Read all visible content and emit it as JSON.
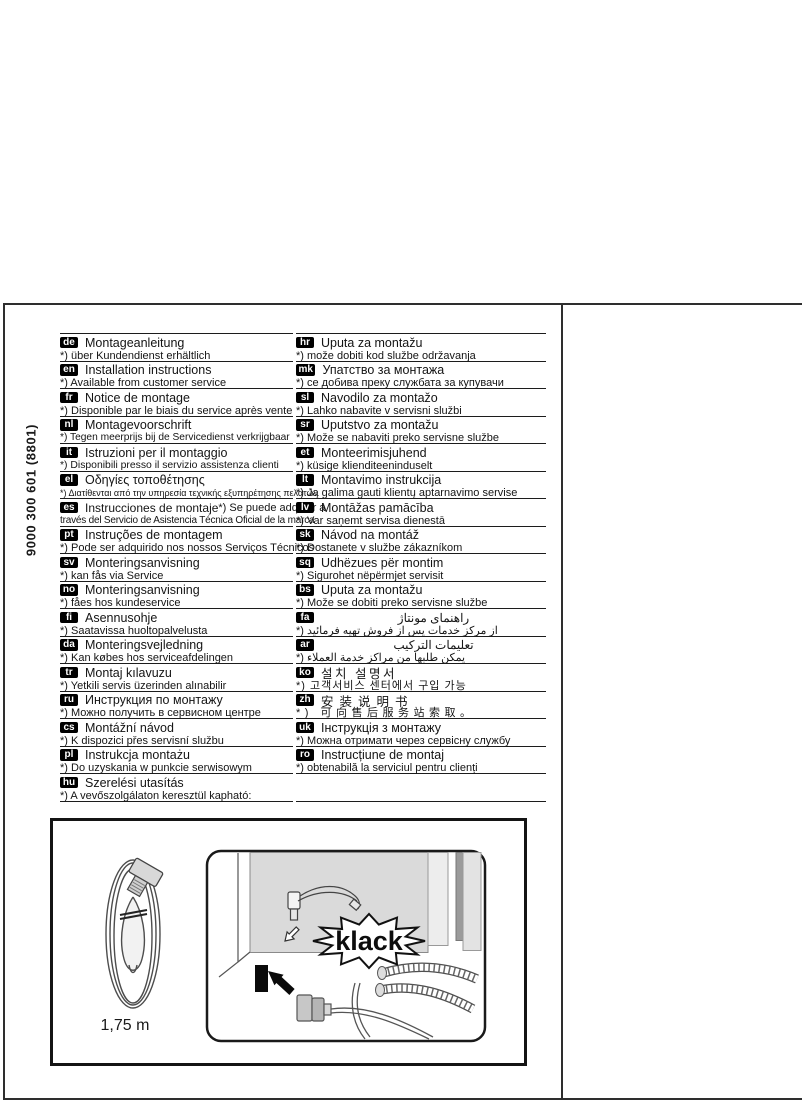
{
  "page": {
    "device_code": "9000 300 601  (8801)",
    "cable_length": "1,75 m",
    "sound_label": "klack"
  },
  "left_column": [
    {
      "code": "de",
      "title": "Montageanleitung",
      "note": "*) über Kundendienst erhältlich"
    },
    {
      "code": "en",
      "title": "Installation instructions",
      "note": "*) Available from customer service"
    },
    {
      "code": "fr",
      "title": "Notice de montage",
      "note": "*) Disponible par le biais du service après vente"
    },
    {
      "code": "nl",
      "title": "Montagevoorschrift",
      "note": "*) Tegen meerprijs bij de Servicedienst verkrijgbaar"
    },
    {
      "code": "it",
      "title": "Istruzioni per il montaggio",
      "note": "*) Disponibili presso il servizio assistenza clienti"
    },
    {
      "code": "el",
      "title": "Οδηγίες τοποθέτησης",
      "note": "*) Διατίθενται από την υπηρεσία τεχνικής εξυπηρέτησης πελατών"
    },
    {
      "code": "es",
      "title": "Instrucciones de montaje",
      "title_note": "*) Se puede adquirir a",
      "note": "través del Servicio de Asistencia Técnica Oficial de la marca"
    },
    {
      "code": "pt",
      "title": "Instruções de montagem",
      "note": "*) Pode ser adquirido nos nossos Serviços Técnicos"
    },
    {
      "code": "sv",
      "title": "Monteringsanvisning",
      "note": "*) kan fås via Service"
    },
    {
      "code": "no",
      "title": "Monteringsanvisning",
      "note": "*) fåes hos kundeservice"
    },
    {
      "code": "fi",
      "title": "Asennusohje",
      "note": "*) Saatavissa huoltopalvelusta"
    },
    {
      "code": "da",
      "title": "Monteringsvejledning",
      "note": "*) Kan købes hos serviceafdelingen"
    },
    {
      "code": "tr",
      "title": "Montaj kılavuzu",
      "note": "*) Yetkili servis üzerinden alınabilir"
    },
    {
      "code": "ru",
      "title": "Инструкция по монтажу",
      "note": "*) Можно получить в сервисном центре"
    },
    {
      "code": "cs",
      "title": "Montážní návod",
      "note": "*) K dispozici přes servisní službu"
    },
    {
      "code": "pl",
      "title": "Instrukcja montażu",
      "note": "*) Do uzyskania w punkcie serwisowym"
    },
    {
      "code": "hu",
      "title": "Szerelési utasítás",
      "note": "*) A vevőszolgálaton keresztül kapható:"
    }
  ],
  "right_column": [
    {
      "code": "hr",
      "title": "Uputa za montažu",
      "note": "*) može dobiti kod službe održavanja"
    },
    {
      "code": "mk",
      "title": "Упатство за монтажа",
      "note": "*) се добива преку службата за купувачи"
    },
    {
      "code": "sl",
      "title": "Navodilo za montažo",
      "note": "*) Lahko nabavite v servisni službi"
    },
    {
      "code": "sr",
      "title": "Uputstvo za montažu",
      "note": "*) Može se nabaviti preko servisne službe"
    },
    {
      "code": "et",
      "title": "Monteerimisjuhend",
      "note": "*) küsige klienditeeninduselt"
    },
    {
      "code": "lt",
      "title": "Montavimo instrukcija",
      "note": "*) Ją galima gauti klientų aptarnavimo servise"
    },
    {
      "code": "lv",
      "title": "Montāžas pamācība",
      "note": "*) Var saņemt servisa dienestā"
    },
    {
      "code": "sk",
      "title": "Návod na montáž",
      "note": "*) Dostanete v službe zákazníkom"
    },
    {
      "code": "sq",
      "title": "Udhëzues për montim",
      "note": "*) Sigurohet nëpërmjet servisit"
    },
    {
      "code": "bs",
      "title": "Uputa za montažu",
      "note": "*) Može se dobiti preko servisne službe"
    },
    {
      "code": "fa",
      "title": "راهنمای مونتاژ",
      "note": "*) از مرکز خدمات پس از فروش تهیه فرمائید",
      "rtl": true
    },
    {
      "code": "ar",
      "title": "تعليمات التركيب",
      "note": "*) يمكن طلبها من مراكز خدمة العملاء",
      "rtl": true
    },
    {
      "code": "ko",
      "title": "설치 설명서",
      "note": "*) 고객서비스 센터에서 구입 가능"
    },
    {
      "code": "zh",
      "title": "安装说明书",
      "note": "*) 可向售后服务站索取。"
    },
    {
      "code": "uk",
      "title": "Інструкція з монтажу",
      "note": "*) Можна отримати через сервісну службу"
    },
    {
      "code": "ro",
      "title": "Instrucțiune de montaj",
      "note": "*) obtenabilă la serviciul pentru clienți"
    }
  ]
}
